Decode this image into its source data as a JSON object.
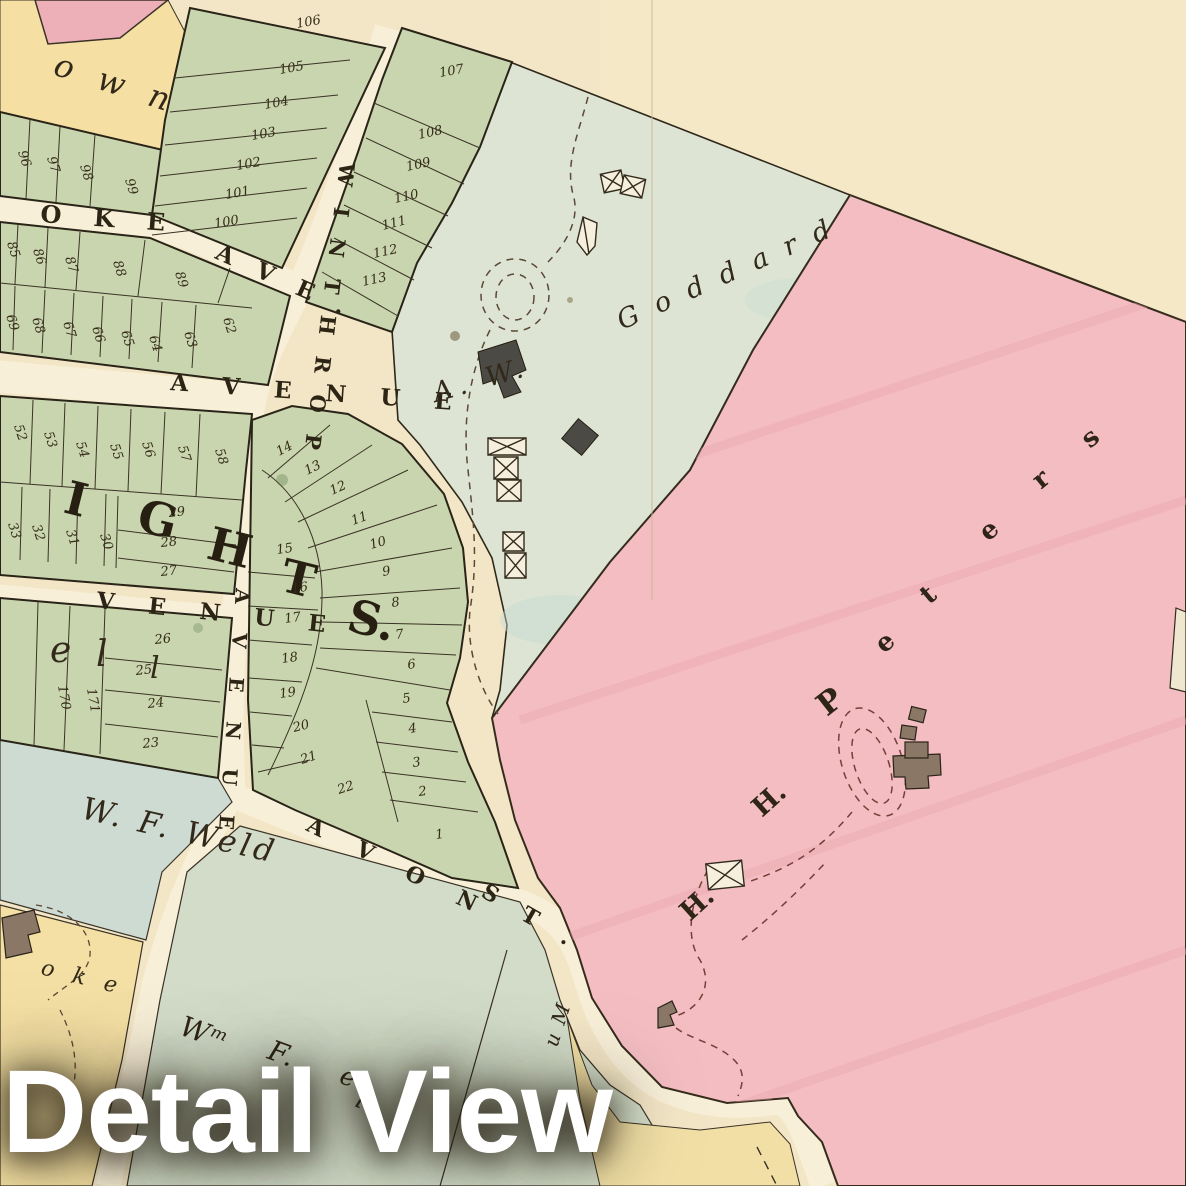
{
  "overlay": {
    "title": "Detail View"
  },
  "colors": {
    "paper": "#f3e6c6",
    "road": "#f8efd8",
    "lot_green": "#c9d5ae",
    "goddard_green": "#dde4d3",
    "weld_bluegreen": "#cddbd3",
    "wmweld_green": "#d2dcc8",
    "peters_pink": "#f3bdc2",
    "corner_pink": "#eeb0b8",
    "yellow_lot": "#f5dfa2",
    "ink": "#2a2318",
    "dash_brown": "#5c4836"
  },
  "map": {
    "streets": [
      {
        "t": "W I N T H R O P",
        "x": 340,
        "y": 162,
        "r": 97,
        "s": 21,
        "ls": 7,
        "name": "winthrop-street-label"
      },
      {
        "t": "O K E",
        "x": 40,
        "y": 222,
        "r": 4,
        "s": 24,
        "ls": 12,
        "name": "oke-ave-label"
      },
      {
        "t": "A V E .",
        "x": 214,
        "y": 258,
        "r": 24,
        "s": 23,
        "ls": 9,
        "name": "oke-ave-suffix-label"
      },
      {
        "t": "A V E N U E",
        "x": 170,
        "y": 390,
        "r": 4,
        "s": 23,
        "ls": 13,
        "name": "avenue-horizontal-label"
      },
      {
        "t": "A V E N U E",
        "x": 236,
        "y": 588,
        "r": 94,
        "s": 20,
        "ls": 11,
        "name": "avenue-vertical-label"
      },
      {
        "t": "V E N U E",
        "x": 96,
        "y": 608,
        "r": 6,
        "s": 23,
        "ls": 13,
        "name": "venue-label"
      },
      {
        "t": "A V O N",
        "x": 305,
        "y": 830,
        "r": 26,
        "s": 22,
        "ls": 15,
        "name": "avon-street-label"
      },
      {
        "t": "S T .",
        "x": 480,
        "y": 896,
        "r": 30,
        "s": 22,
        "ls": 11,
        "name": "avon-st-suffix-label"
      }
    ],
    "owners": [
      {
        "t": "A. W.",
        "x": 436,
        "y": 402,
        "r": -16,
        "s": 27,
        "ls": 6,
        "name": "goddard-owner-prefix"
      },
      {
        "t": "G o d d a r d",
        "x": 622,
        "y": 330,
        "r": -24,
        "s": 27,
        "ls": 5,
        "name": "goddard-owner-name"
      },
      {
        "t": "W. F. Weld",
        "x": 80,
        "y": 818,
        "r": 13,
        "s": 31,
        "ls": 4,
        "name": "wf-weld-owner-name"
      },
      {
        "t": "Wᵐ",
        "x": 178,
        "y": 1034,
        "r": 20,
        "s": 28,
        "ls": 2,
        "name": "wm-weld-owner-prefix"
      },
      {
        "t": "F.",
        "x": 266,
        "y": 1058,
        "r": 20,
        "s": 28,
        "ls": 2,
        "name": "wm-weld-owner-initial"
      },
      {
        "t": "e",
        "x": 338,
        "y": 1082,
        "r": 22,
        "s": 26,
        "ls": 2,
        "name": "wm-weld-owner-fragment-e"
      },
      {
        "t": "l",
        "x": 354,
        "y": 1106,
        "r": 22,
        "s": 26,
        "ls": 2,
        "name": "wm-weld-owner-fragment-l"
      },
      {
        "t": "u M",
        "x": 557,
        "y": 1048,
        "r": -72,
        "s": 20,
        "ls": 2,
        "name": "rotated-owner-fragment"
      },
      {
        "t": "o w n",
        "x": 52,
        "y": 74,
        "r": 18,
        "s": 32,
        "ls": 8,
        "name": "own-name-fragment"
      },
      {
        "t": "o k e",
        "x": 40,
        "y": 974,
        "r": 14,
        "s": 22,
        "ls": 6,
        "name": "oke-name-fragment"
      },
      {
        "t": "e",
        "x": 50,
        "y": 662,
        "r": 0,
        "s": 36,
        "ls": 0,
        "name": "lot-letter-e"
      },
      {
        "t": "l",
        "x": 96,
        "y": 666,
        "r": 0,
        "s": 36,
        "ls": 0,
        "name": "lot-letter-l"
      },
      {
        "t": "l",
        "x": 150,
        "y": 678,
        "r": 0,
        "s": 30,
        "ls": 0,
        "name": "lot-letter-l2"
      }
    ],
    "peters_letters": [
      {
        "t": "H.",
        "x": 690,
        "y": 922,
        "r": -42,
        "s": 27,
        "name": "peters-letter-h1"
      },
      {
        "t": "H.",
        "x": 762,
        "y": 818,
        "r": -42,
        "s": 27,
        "name": "peters-letter-h2"
      },
      {
        "t": "P",
        "x": 827,
        "y": 717,
        "r": -38,
        "s": 31,
        "name": "peters-letter-p"
      },
      {
        "t": "e",
        "x": 884,
        "y": 654,
        "r": -40,
        "s": 26,
        "name": "peters-letter-e1"
      },
      {
        "t": "t",
        "x": 929,
        "y": 605,
        "r": -40,
        "s": 26,
        "name": "peters-letter-t"
      },
      {
        "t": "e",
        "x": 988,
        "y": 542,
        "r": -40,
        "s": 26,
        "name": "peters-letter-e2"
      },
      {
        "t": "r",
        "x": 1041,
        "y": 490,
        "r": -40,
        "s": 26,
        "name": "peters-letter-r"
      },
      {
        "t": "s",
        "x": 1090,
        "y": 449,
        "r": -40,
        "s": 26,
        "name": "peters-letter-s"
      }
    ],
    "heights_letters": [
      {
        "t": "I",
        "x": 62,
        "y": 512,
        "r": 14,
        "s": 46,
        "name": "heights-letter-i"
      },
      {
        "t": "G",
        "x": 135,
        "y": 530,
        "r": 14,
        "s": 46,
        "name": "heights-letter-g"
      },
      {
        "t": "H",
        "x": 205,
        "y": 558,
        "r": 14,
        "s": 46,
        "name": "heights-letter-h"
      },
      {
        "t": "T",
        "x": 278,
        "y": 590,
        "r": 14,
        "s": 46,
        "name": "heights-letter-t"
      },
      {
        "t": "S.",
        "x": 345,
        "y": 630,
        "r": 14,
        "s": 46,
        "name": "heights-letter-s"
      }
    ],
    "lots": [
      {
        "t": "106",
        "x": 297,
        "y": 28,
        "r": -10
      },
      {
        "t": "105",
        "x": 280,
        "y": 74,
        "r": -10
      },
      {
        "t": "104",
        "x": 265,
        "y": 109,
        "r": -10
      },
      {
        "t": "103",
        "x": 252,
        "y": 140,
        "r": -10
      },
      {
        "t": "102",
        "x": 237,
        "y": 170,
        "r": -10
      },
      {
        "t": "101",
        "x": 226,
        "y": 199,
        "r": -10
      },
      {
        "t": "100",
        "x": 215,
        "y": 228,
        "r": -10
      },
      {
        "t": "96",
        "x": 18,
        "y": 152,
        "r": 72
      },
      {
        "t": "97",
        "x": 47,
        "y": 158,
        "r": 72
      },
      {
        "t": "98",
        "x": 80,
        "y": 166,
        "r": 72
      },
      {
        "t": "99",
        "x": 125,
        "y": 180,
        "r": 72
      },
      {
        "t": "107",
        "x": 440,
        "y": 77,
        "r": -10
      },
      {
        "t": "108",
        "x": 419,
        "y": 139,
        "r": -12
      },
      {
        "t": "109",
        "x": 407,
        "y": 171,
        "r": -12
      },
      {
        "t": "110",
        "x": 395,
        "y": 203,
        "r": -12
      },
      {
        "t": "111",
        "x": 383,
        "y": 230,
        "r": -14
      },
      {
        "t": "112",
        "x": 374,
        "y": 258,
        "r": -12
      },
      {
        "t": "113",
        "x": 363,
        "y": 286,
        "r": -12
      },
      {
        "t": "85",
        "x": 7,
        "y": 243,
        "r": 72
      },
      {
        "t": "86",
        "x": 33,
        "y": 250,
        "r": 72
      },
      {
        "t": "87",
        "x": 65,
        "y": 258,
        "r": 72
      },
      {
        "t": "88",
        "x": 113,
        "y": 262,
        "r": 72
      },
      {
        "t": "89",
        "x": 175,
        "y": 273,
        "r": 72
      },
      {
        "t": "69",
        "x": 6,
        "y": 316,
        "r": 72
      },
      {
        "t": "68",
        "x": 32,
        "y": 319,
        "r": 72
      },
      {
        "t": "67",
        "x": 63,
        "y": 323,
        "r": 72
      },
      {
        "t": "66",
        "x": 92,
        "y": 328,
        "r": 72
      },
      {
        "t": "65",
        "x": 121,
        "y": 332,
        "r": 72
      },
      {
        "t": "64",
        "x": 149,
        "y": 337,
        "r": 72
      },
      {
        "t": "63",
        "x": 184,
        "y": 333,
        "r": 72
      },
      {
        "t": "62",
        "x": 223,
        "y": 319,
        "r": 72
      },
      {
        "t": "52",
        "x": 14,
        "y": 426,
        "r": 72
      },
      {
        "t": "53",
        "x": 44,
        "y": 433,
        "r": 72
      },
      {
        "t": "54",
        "x": 76,
        "y": 443,
        "r": 72
      },
      {
        "t": "55",
        "x": 110,
        "y": 445,
        "r": 72
      },
      {
        "t": "56",
        "x": 142,
        "y": 443,
        "r": 72
      },
      {
        "t": "57",
        "x": 178,
        "y": 447,
        "r": 72
      },
      {
        "t": "58",
        "x": 215,
        "y": 450,
        "r": 72
      },
      {
        "t": "33",
        "x": 8,
        "y": 524,
        "r": 72
      },
      {
        "t": "32",
        "x": 32,
        "y": 526,
        "r": 72
      },
      {
        "t": "31",
        "x": 66,
        "y": 531,
        "r": 72
      },
      {
        "t": "30",
        "x": 100,
        "y": 535,
        "r": 72
      },
      {
        "t": "29",
        "x": 169,
        "y": 517,
        "r": -6
      },
      {
        "t": "28",
        "x": 161,
        "y": 547,
        "r": -6
      },
      {
        "t": "27",
        "x": 161,
        "y": 576,
        "r": -6
      },
      {
        "t": "26",
        "x": 155,
        "y": 644,
        "r": -6
      },
      {
        "t": "25",
        "x": 136,
        "y": 675,
        "r": -6
      },
      {
        "t": "24",
        "x": 148,
        "y": 708,
        "r": -6
      },
      {
        "t": "23",
        "x": 143,
        "y": 748,
        "r": -6
      },
      {
        "t": "170",
        "x": 58,
        "y": 686,
        "r": 80
      },
      {
        "t": "171",
        "x": 87,
        "y": 689,
        "r": 80
      },
      {
        "t": "14",
        "x": 279,
        "y": 456,
        "r": -28
      },
      {
        "t": "13",
        "x": 307,
        "y": 475,
        "r": -26
      },
      {
        "t": "12",
        "x": 332,
        "y": 495,
        "r": -24
      },
      {
        "t": "11",
        "x": 353,
        "y": 525,
        "r": -20
      },
      {
        "t": "10",
        "x": 371,
        "y": 549,
        "r": -16
      },
      {
        "t": "9",
        "x": 383,
        "y": 576,
        "r": -10
      },
      {
        "t": "8",
        "x": 392,
        "y": 607,
        "r": -8
      },
      {
        "t": "7",
        "x": 396,
        "y": 639,
        "r": -8
      },
      {
        "t": "6",
        "x": 408,
        "y": 669,
        "r": -8
      },
      {
        "t": "5",
        "x": 403,
        "y": 703,
        "r": -8
      },
      {
        "t": "4",
        "x": 409,
        "y": 733,
        "r": -8
      },
      {
        "t": "3",
        "x": 413,
        "y": 767,
        "r": -8
      },
      {
        "t": "2",
        "x": 419,
        "y": 796,
        "r": -8
      },
      {
        "t": "1",
        "x": 436,
        "y": 839,
        "r": -8
      },
      {
        "t": "15",
        "x": 277,
        "y": 554,
        "r": -8
      },
      {
        "t": "16",
        "x": 292,
        "y": 593,
        "r": -8
      },
      {
        "t": "17",
        "x": 285,
        "y": 623,
        "r": -8
      },
      {
        "t": "18",
        "x": 282,
        "y": 663,
        "r": -8
      },
      {
        "t": "19",
        "x": 280,
        "y": 698,
        "r": -8
      },
      {
        "t": "20",
        "x": 294,
        "y": 732,
        "r": -14
      },
      {
        "t": "21",
        "x": 302,
        "y": 764,
        "r": -18
      },
      {
        "t": "22",
        "x": 339,
        "y": 794,
        "r": -18
      }
    ]
  }
}
